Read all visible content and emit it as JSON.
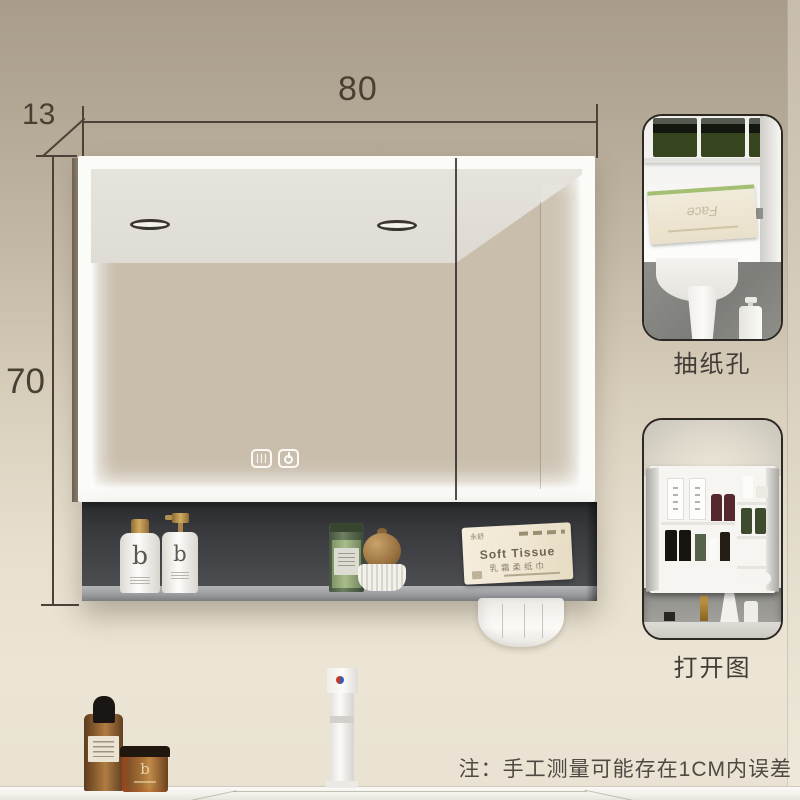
{
  "page": {
    "subject": "LED bathroom mirror cabinet product photo with dimensions"
  },
  "dimensions": {
    "width": "80",
    "depth": "13",
    "height": "70"
  },
  "insets": [
    {
      "caption": "抽纸孔"
    },
    {
      "caption": "打开图"
    }
  ],
  "note": "注：手工测量可能存在1CM内误差",
  "mirror": {
    "controls": [
      {
        "icon": "defog"
      },
      {
        "icon": "power"
      }
    ]
  },
  "shelf_items": {
    "bottle1_logo": "b",
    "bottle2_logo": "b",
    "tissue_box": {
      "brand": "永舒",
      "title": "Soft Tissue",
      "subtitle": "乳霜柔纸巾"
    }
  },
  "inset1": {
    "tissue_brand": "Face"
  },
  "counter_items": {
    "jar_logo": "b"
  },
  "colors": {
    "wall_top": "#a99c8b",
    "wall_bottom": "#ece5d5",
    "shelf_charcoal": "#3a3b3f",
    "dimension_lines": "#4b4238",
    "led_white": "#ffffff",
    "caption_text": "#413d36",
    "tissue_box_cream": "#efe6d2",
    "gold_cap": "#d2ab62",
    "amber_glass": "#9a6a36"
  }
}
